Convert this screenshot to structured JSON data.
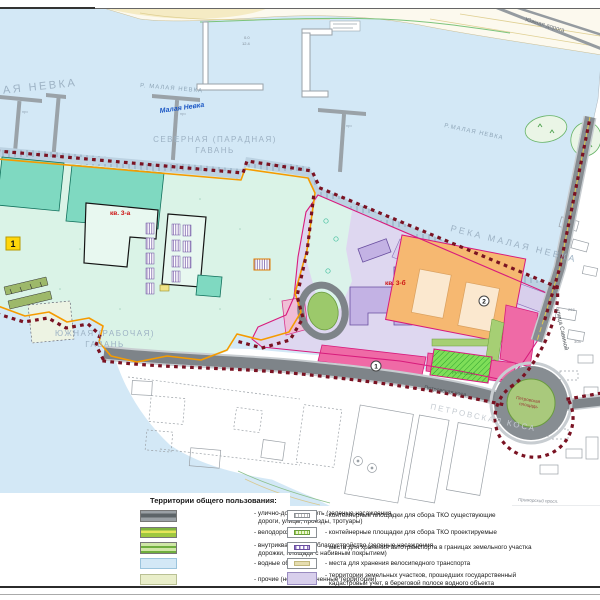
{
  "colors": {
    "water": "#d3e8f6",
    "land": "#ffffff",
    "topland": "#fcf9ee",
    "beach": "#f5ebc4",
    "quay": "#bcd2e2",
    "teal_zone": "#daf3e7",
    "teal_bldg": "#7fd9c1",
    "lavender": "#ded7f0",
    "purple_bldg": "#c3b2e4",
    "purple_strip": "#d8cfec",
    "mint": "#dbf3ea",
    "orange_bldg": "#f6b871",
    "courtyard": "#fbe8cf",
    "pink": "#ef6aa6",
    "green": "#9cc96b",
    "green_hatch": "#7ede58",
    "road": "#7e8489",
    "road_edge": "#c8cdd1",
    "bred": "#7a1222",
    "borange": "#f59b00",
    "magenta": "#d81b7c",
    "yellow_marker": "#ffd60a",
    "water_label": "#9db2c4",
    "blue_label": "#1a56c4",
    "red_label": "#cc1111"
  },
  "map": {
    "labels": {
      "malaya_nevka": "МАЛАЯ НЕВКА",
      "r_malaya_nevka": "Р. МАЛАЯ НЕВКА",
      "malaya_nevka_blue": "Малая Невка",
      "r_malaya_nevka2": "Р.МАЛАЯ НЕВКА",
      "reka_malaya_nevka": "РЕКА МАЛАЯ НЕВКА",
      "severnaya_1": "СЕВЕРНАЯ (ПАРАДНАЯ)",
      "severnaya_2": "ГАВАНЬ",
      "yuzhnaya_1": "ЮЖНАЯ (РАБОЧАЯ)",
      "yuzhnaya_2": "ГАВАНЬ",
      "yuzhnaya_doroga": "Южная дорога",
      "ulitsa_savinoy": "улица Савиной",
      "petrovskaya_kosa": "Петровская коса",
      "petrovskaya_kosa_ghost": "ПЕТРОВСКАЯ КОСА",
      "petrovskaya_pl_1": "Петровская",
      "petrovskaya_pl_2": "площадь",
      "primorsky": "Приморский просп.",
      "kv3a": "кв. 3-а",
      "kv3b": "кв. 3-б",
      "marker1": "1",
      "badge1": "1",
      "badge2": "2",
      "uchastok": "уч. № 12010",
      "prch": "прч",
      "depth1": "0.0",
      "depth2": "12.4",
      "n268": "268",
      "n308": "308"
    }
  },
  "legend": {
    "title": "Территории общего пользования:",
    "left": [
      {
        "line1": "- улично-дорожная сеть (зеленые насаждения,",
        "line2": "дороги, улицы, проезды, тротуары)"
      },
      {
        "line1": "- велодорожки",
        "line2": ""
      },
      {
        "line1": "- внутриквартальное благоустройство (зеленые насаждения,",
        "line2": "дорожки, площади с набивным покрытием)"
      },
      {
        "line1": "- водные объекты",
        "line2": ""
      },
      {
        "line1": "- прочие (неразграниченные территории)",
        "line2": ""
      }
    ],
    "right": [
      {
        "line1": "- контейнерные площадки для сбора ТКО существующие",
        "line2": ""
      },
      {
        "line1": "- контейнерные площадки для сбора ТКО проектируемые",
        "line2": ""
      },
      {
        "line1": "- места для хранения автотранспорта в границах земельного участка",
        "line2": ""
      },
      {
        "line1": "- места для хранения велосипедного транспорта",
        "line2": ""
      },
      {
        "line1": "- территории земельных участков, прошедших государственный",
        "line2": "кадастровый учет, в береговой полосе водного объекта"
      }
    ]
  }
}
